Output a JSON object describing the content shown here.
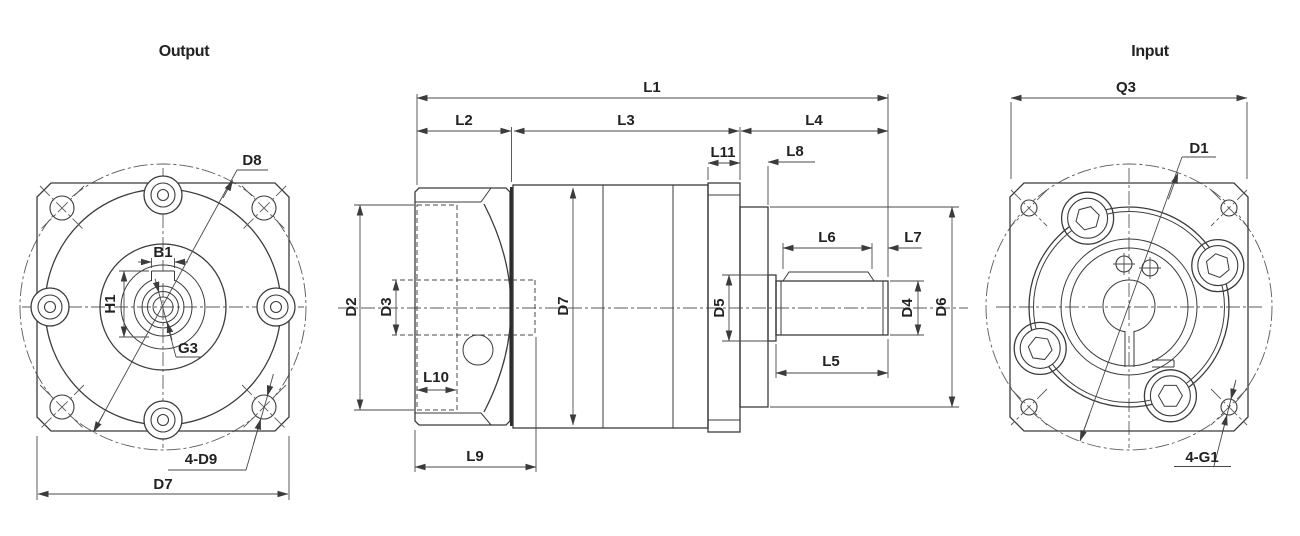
{
  "titles": {
    "output": "Output",
    "input": "Input"
  },
  "colors": {
    "background": "#ffffff",
    "outline": "#3b3b3b",
    "dimension": "#4a4a4a",
    "text": "#222222"
  },
  "output_view": {
    "labels": {
      "bolt_circle": "D8",
      "key_width": "B1",
      "key_height": "H1",
      "center_thread": "G3",
      "corner_holes": "4-D9",
      "flange_width": "D7"
    }
  },
  "side_view": {
    "labels": {
      "l1": "L1",
      "l2": "L2",
      "l3": "L3",
      "l4": "L4",
      "l5": "L5",
      "l6": "L6",
      "l7": "L7",
      "l8": "L8",
      "l9": "L9",
      "l10": "L10",
      "l11": "L11",
      "d2": "D2",
      "d3": "D3",
      "d4": "D4",
      "d5": "D5",
      "d6": "D6",
      "d7": "D7"
    }
  },
  "input_view": {
    "labels": {
      "flange_width": "Q3",
      "bolt_circle": "D1",
      "corner_holes": "4-G1"
    }
  }
}
